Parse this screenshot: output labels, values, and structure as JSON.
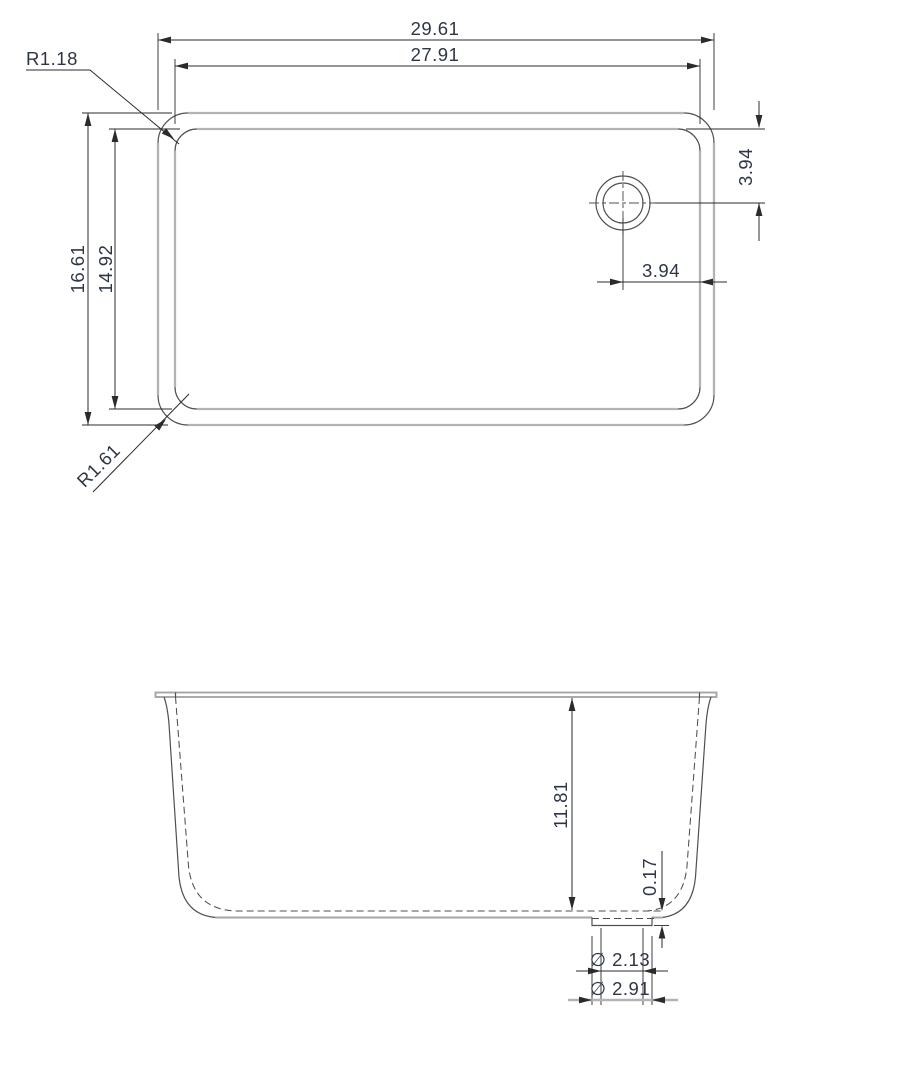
{
  "top_view": {
    "width_outer": "29.61",
    "width_inner": "27.91",
    "height_outer": "16.61",
    "height_inner": "14.92",
    "corner_radius_inner": "R1.18",
    "corner_radius_outer": "R1.61",
    "drain_offset_from_top": "3.94",
    "drain_offset_from_right": "3.94"
  },
  "front_view": {
    "depth": "11.81",
    "drain_boss_height": "0.17",
    "drain_diameter_inner": "∅ 2.13",
    "drain_diameter_outer": "∅ 2.91"
  },
  "colors": {
    "background": "#ffffff",
    "edge_gray": "#b3b3b3",
    "edge_gray2": "#a6a6a6",
    "edge_dark": "#4f4f4f",
    "dim_line": "#2b2b2b",
    "dim_text": "#2e3644"
  }
}
